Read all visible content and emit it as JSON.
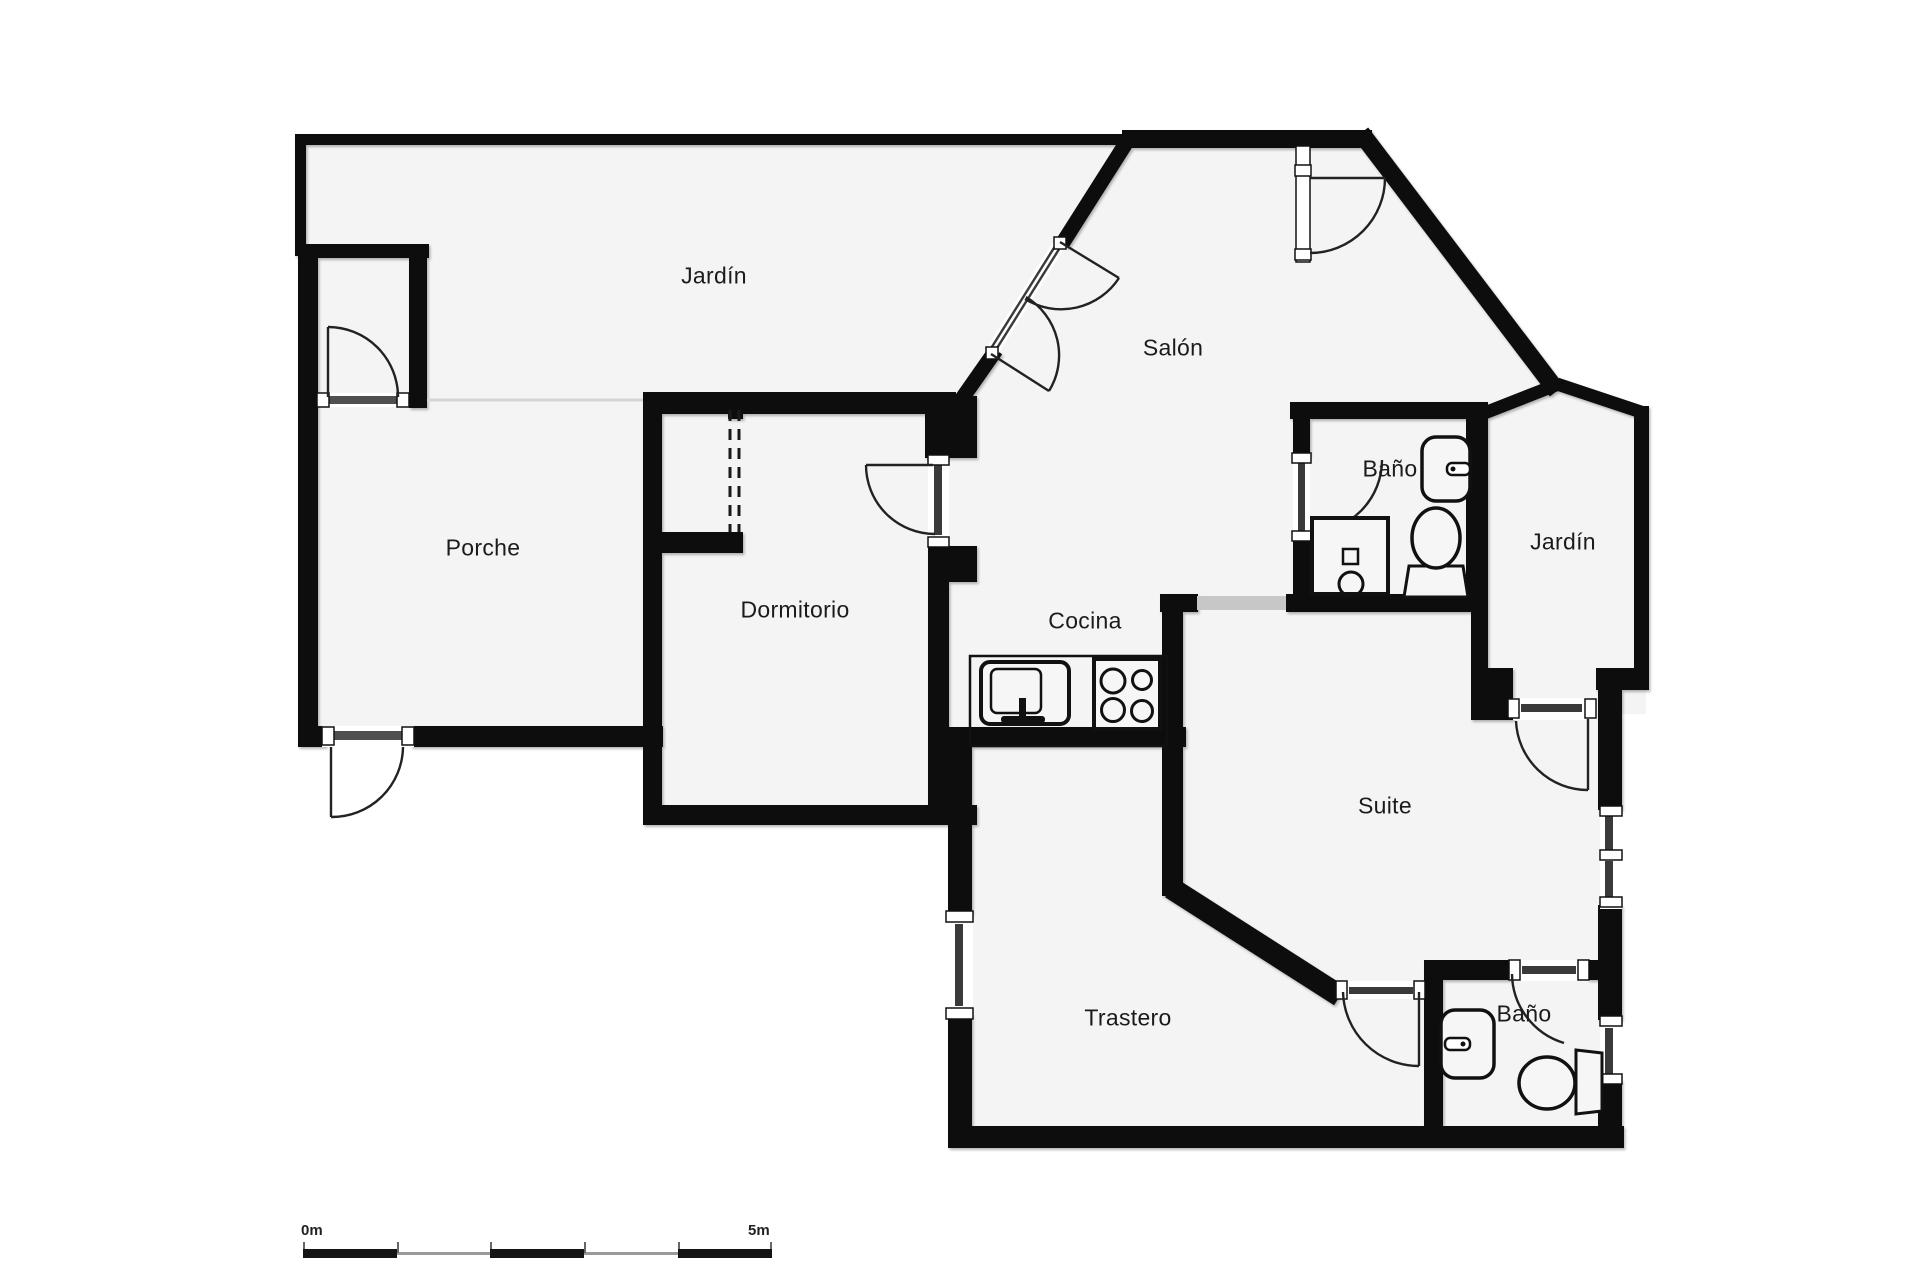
{
  "figure_type": "floor-plan",
  "rooms": {
    "jardin_top": {
      "label": "Jardín"
    },
    "salon": {
      "label": "Salón"
    },
    "porche": {
      "label": "Porche"
    },
    "dormitorio": {
      "label": "Dormitorio"
    },
    "cocina": {
      "label": "Cocina"
    },
    "bano_top": {
      "label": "Baño"
    },
    "jardin_right": {
      "label": "Jardín"
    },
    "suite": {
      "label": "Suite"
    },
    "trastero": {
      "label": "Trastero"
    },
    "bano_bottom": {
      "label": "Baño"
    }
  },
  "scale_bar": {
    "start_label": "0m",
    "end_label": "5m"
  },
  "colors": {
    "wall": "#0d0d0d",
    "floor": "#f4f4f4",
    "glazing": "#3a3a3a",
    "open_passage": "#c7c7c7",
    "door_sill": "#4f4f4f",
    "background": "#ffffff"
  },
  "fixtures": [
    "kitchen-sink",
    "stove-4-burners",
    "bathroom-sink-top",
    "toilet-top",
    "shower-tray",
    "bathroom-sink-bottom",
    "toilet-bottom"
  ]
}
